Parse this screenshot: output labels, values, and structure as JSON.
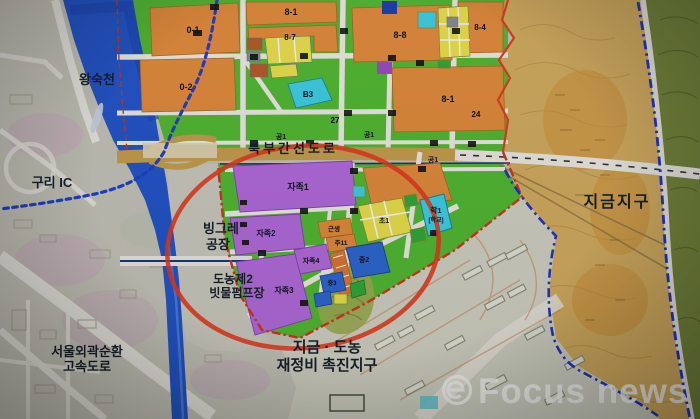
{
  "map": {
    "place_labels": {
      "river": "왕숙천",
      "guri_ic": "구리 IC",
      "binggrae_1": "빙그레",
      "binggrae_2": "공장",
      "pump_1": "도농제2",
      "pump_2": "빗물펌프장",
      "expressway_1": "서울외곽순환",
      "expressway_2": "고속도로",
      "jigeum": "지금지구",
      "arterial": "북부간선도로",
      "promo_1": "지금 · 도농",
      "promo_2": "재정비 촉진지구"
    },
    "parcel_labels": {
      "p01": "0-1",
      "p81a": "8-1",
      "p87": "8-7",
      "p88": "8-8",
      "p02": "0-2",
      "p81b": "8-1",
      "p84": "8-4",
      "pb3": "B3",
      "p27": "27",
      "p24": "24",
      "g1a": "공1",
      "g1b": "공1",
      "g1c": "공1",
      "jj1": "자족1",
      "jj2": "자족2",
      "jj3": "자족3",
      "jj4": "자족4",
      "gs": "근생",
      "ju11": "주11",
      "j2": "중2",
      "j3": "중3",
      "hak1": "학1",
      "hak1b": "[학교]",
      "cho1": "초1"
    }
  },
  "watermark": {
    "brand": "Focus news",
    "logo_glyph": "e"
  },
  "colors": {
    "planned_green": "#54bd33",
    "residential_orange": "#e78e3c",
    "self_sufficiency_purple": "#b66de0",
    "school_cyan": "#3fd4ea",
    "commercial_yellow": "#f0e64e",
    "business_blue": "#2e6ad6",
    "jigeum_tan": "#d7b061",
    "river_blue": "#2356cc",
    "highlight_red": "#e03a20",
    "boundary_blue": "#2036c8"
  }
}
